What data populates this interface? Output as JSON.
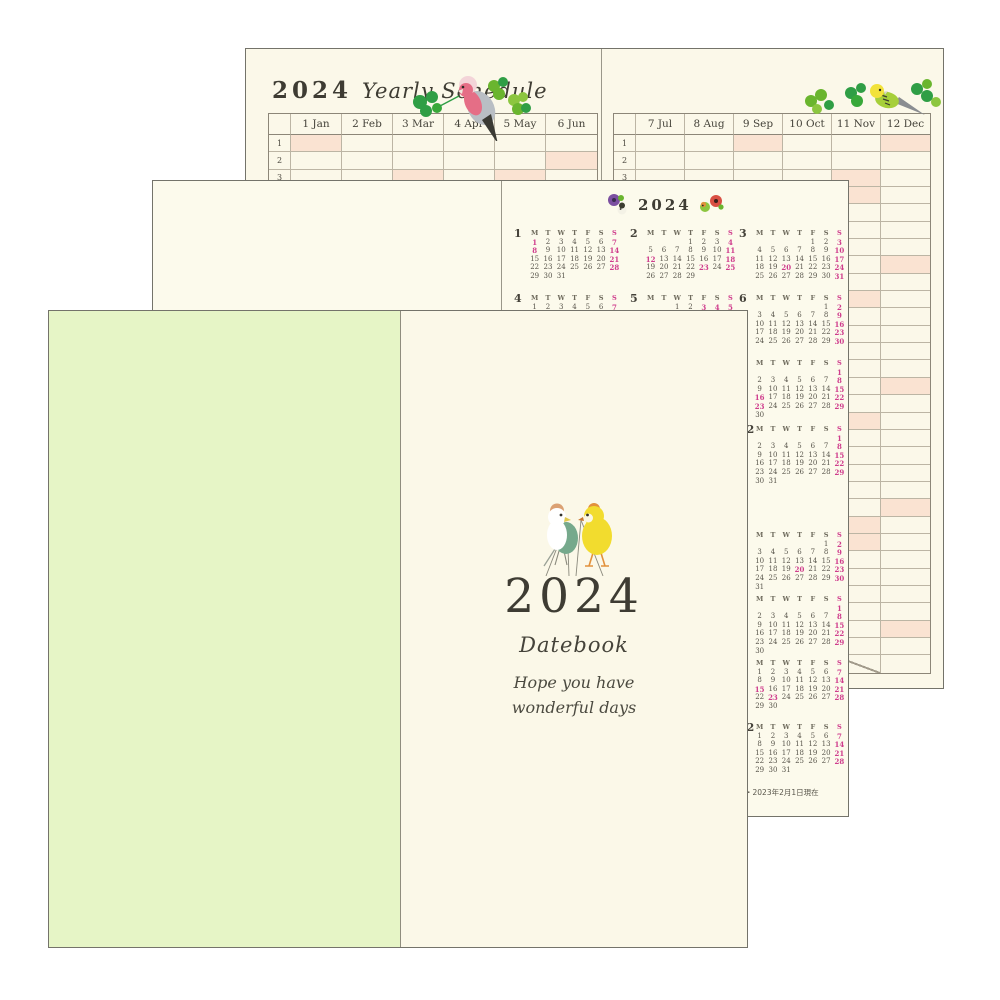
{
  "back_spread": {
    "year": "2024",
    "script_title": "Yearly Schedule",
    "day_rows": 31
  },
  "year_2024": {
    "months": [
      {
        "num": 1,
        "label": "1 Jan",
        "days": 31,
        "offset": 0,
        "pink": [
          1,
          7,
          8,
          14,
          21,
          28
        ]
      },
      {
        "num": 2,
        "label": "2 Feb",
        "days": 29,
        "offset": 3,
        "pink": [
          4,
          11,
          12,
          18,
          23,
          25
        ]
      },
      {
        "num": 3,
        "label": "3 Mar",
        "days": 31,
        "offset": 4,
        "pink": [
          3,
          10,
          17,
          20,
          24,
          31
        ]
      },
      {
        "num": 4,
        "label": "4 Apr",
        "days": 30,
        "offset": 0,
        "pink": [
          7,
          14,
          21,
          28,
          29
        ]
      },
      {
        "num": 5,
        "label": "5 May",
        "days": 31,
        "offset": 2,
        "pink": [
          3,
          4,
          5,
          6,
          12,
          19,
          26
        ]
      },
      {
        "num": 6,
        "label": "6 Jun",
        "days": 30,
        "offset": 5,
        "pink": [
          2,
          9,
          16,
          23,
          30
        ]
      },
      {
        "num": 7,
        "label": "7 Jul",
        "days": 31,
        "offset": 0,
        "pink": [
          7,
          14,
          15,
          21,
          28
        ]
      },
      {
        "num": 8,
        "label": "8 Aug",
        "days": 31,
        "offset": 3,
        "pink": [
          4,
          11,
          12,
          18,
          25
        ]
      },
      {
        "num": 9,
        "label": "9 Sep",
        "days": 30,
        "offset": 6,
        "pink": [
          1,
          8,
          15,
          16,
          22,
          23,
          29
        ]
      },
      {
        "num": 10,
        "label": "10 Oct",
        "days": 31,
        "offset": 1,
        "pink": [
          6,
          13,
          14,
          20,
          27
        ]
      },
      {
        "num": 11,
        "label": "11 Nov",
        "days": 30,
        "offset": 4,
        "pink": [
          3,
          4,
          10,
          17,
          23,
          24
        ]
      },
      {
        "num": 12,
        "label": "12 Dec",
        "days": 31,
        "offset": 6,
        "pink": [
          1,
          8,
          15,
          22,
          29
        ]
      }
    ]
  },
  "year_2025_visible": {
    "months": [
      {
        "num": 3,
        "days": 31,
        "offset": 5,
        "pink": [
          2,
          9,
          16,
          20,
          23,
          30
        ]
      },
      {
        "num": 6,
        "days": 30,
        "offset": 6,
        "pink": [
          1,
          8,
          15,
          22,
          29
        ]
      },
      {
        "num": 9,
        "days": 30,
        "offset": 0,
        "pink": [
          7,
          14,
          15,
          21,
          23,
          28
        ]
      },
      {
        "num": 12,
        "days": 31,
        "offset": 0,
        "pink": [
          7,
          14,
          21,
          28
        ]
      }
    ]
  },
  "mini_calendar": {
    "year_title": "2024",
    "weekdays": [
      "M",
      "T",
      "W",
      "T",
      "F",
      "S",
      "S"
    ],
    "footnote": "・2023年2月1日現在"
  },
  "cover": {
    "year": "2024",
    "title": "Datebook",
    "tagline_line1": "Hope you have",
    "tagline_line2": "wonderful days"
  },
  "colors": {
    "paper_cream": "#fbf8e9",
    "cover_green": "#e6f5c6",
    "highlight_pink": "#fae3d2",
    "accent_magenta": "#cf3c8c",
    "grid_line": "#bcb5a4",
    "ink": "#3e3c33",
    "clover_greens": [
      "#2f9e45",
      "#6ab52e",
      "#8cc63f"
    ]
  }
}
